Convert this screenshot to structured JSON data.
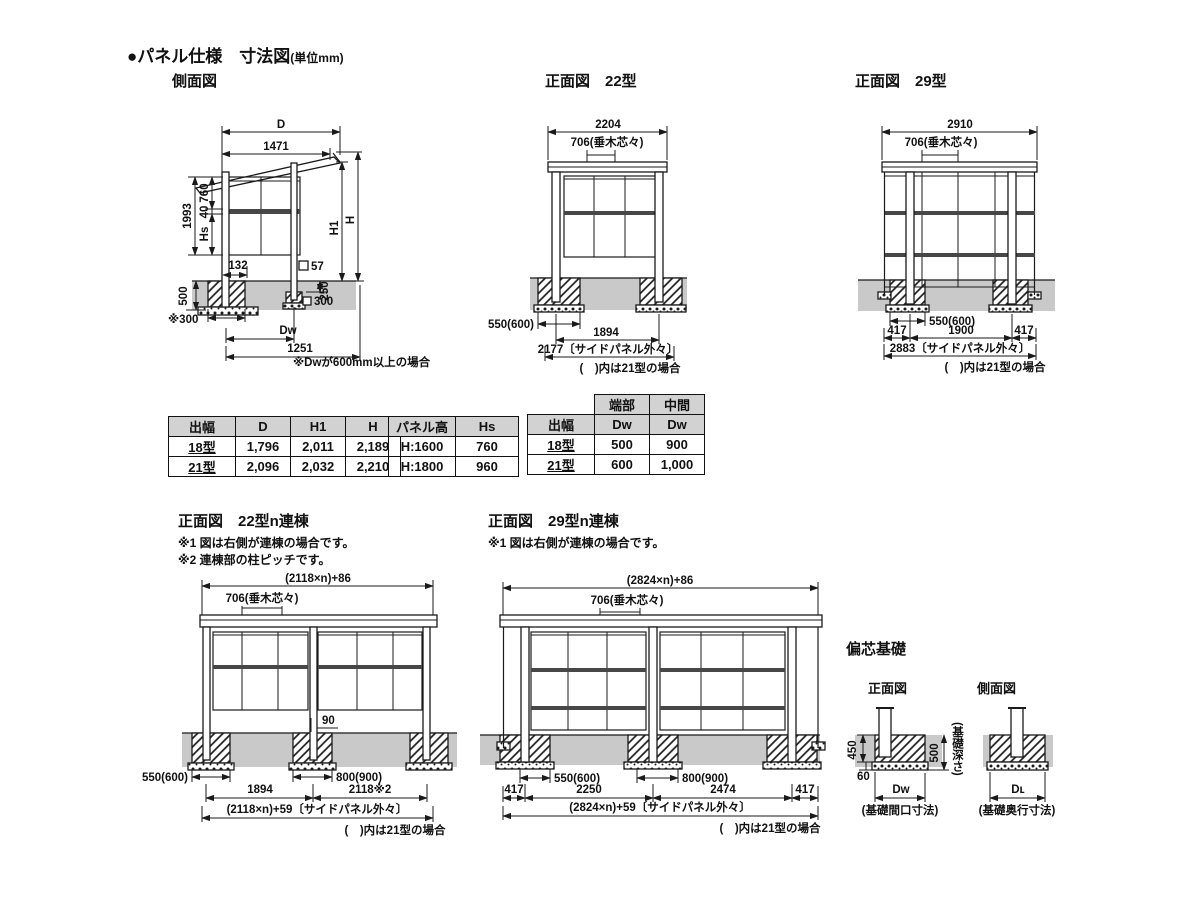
{
  "colors": {
    "ground": "#c9c9c9",
    "table_header": "#d2d2d2",
    "line": "#1a1a1a"
  },
  "page": {
    "title": "●パネル仕様　寸法図",
    "title_unit": "(単位mm)"
  },
  "side_view": {
    "label": "側面図",
    "note": "※Dᴡが600mm以上の場合",
    "dims": {
      "d": "D",
      "w1471": "1471",
      "v1993": "1993",
      "v760": "760",
      "v40": "40",
      "vhs": "Hs",
      "h1": "H1",
      "h": "H",
      "w132": "132",
      "sq57": "57",
      "v500": "500",
      "v250": "250",
      "sq300": "300",
      "n300": "※300",
      "dw": "Dᴡ",
      "w1251": "1251"
    }
  },
  "front22": {
    "label": "正面図　22型",
    "dims": {
      "top": "2204",
      "rafter": "706(垂木芯々)",
      "found": "550(600)",
      "span": "1894",
      "outer": "2177〔サイドパネル外々〕"
    },
    "note": "(　)内は21型の場合"
  },
  "front29": {
    "label": "正面図　29型",
    "dims": {
      "top": "2910",
      "rafter": "706(垂木芯々)",
      "found": "550(600)",
      "l417": "417",
      "span": "1900",
      "r417": "417",
      "outer": "2883〔サイドパネル外々〕"
    },
    "note": "(　)内は21型の場合"
  },
  "ren22": {
    "label": "正面図　22型n連棟",
    "note1": "※1 図は右側が連棟の場合です。",
    "note2": "※2 連棟部の柱ピッチです。",
    "dims": {
      "top": "(2118×n)+86",
      "rafter": "706(垂木芯々)",
      "w90": "90",
      "found": "550(600)",
      "span1": "1894",
      "found2": "800(900)",
      "span2": "2118※2",
      "outer": "(2118×n)+59〔サイドパネル外々〕"
    },
    "note": "(　)内は21型の場合"
  },
  "ren29": {
    "label": "正面図　29型n連棟",
    "note1": "※1 図は右側が連棟の場合です。",
    "dims": {
      "top": "(2824×n)+86",
      "rafter": "706(垂木芯々)",
      "found": "550(600)",
      "found2": "800(900)",
      "l417": "417",
      "span1": "2250",
      "span2": "2474",
      "r417": "417",
      "outer": "(2824×n)+59〔サイドパネル外々〕"
    },
    "note": "(　)内は21型の場合"
  },
  "foundation": {
    "label": "偏芯基礎",
    "front": {
      "label": "正面図",
      "v450": "450",
      "v500": "500",
      "depth": "(基礎深さ)",
      "h60": "60",
      "dw": "Dᴡ",
      "caption": "(基礎間口寸法)"
    },
    "side": {
      "label": "側面図",
      "dl": "Dʟ",
      "caption": "(基礎奥行寸法)"
    }
  },
  "tables": {
    "size": {
      "headers": [
        "出幅",
        "D",
        "H1",
        "H"
      ],
      "rows": [
        [
          "18型",
          "1,796",
          "2,011",
          "2,189"
        ],
        [
          "21型",
          "2,096",
          "2,032",
          "2,210"
        ]
      ]
    },
    "panel": {
      "headers": [
        "パネル高",
        "Hs"
      ],
      "rows": [
        [
          "H:1600",
          "760"
        ],
        [
          "H:1800",
          "960"
        ]
      ]
    },
    "dw": {
      "top_headers": [
        "端部",
        "中間"
      ],
      "headers": [
        "出幅",
        "Dᴡ",
        "Dᴡ"
      ],
      "rows": [
        [
          "18型",
          "500",
          "900"
        ],
        [
          "21型",
          "600",
          "1,000"
        ]
      ]
    }
  }
}
